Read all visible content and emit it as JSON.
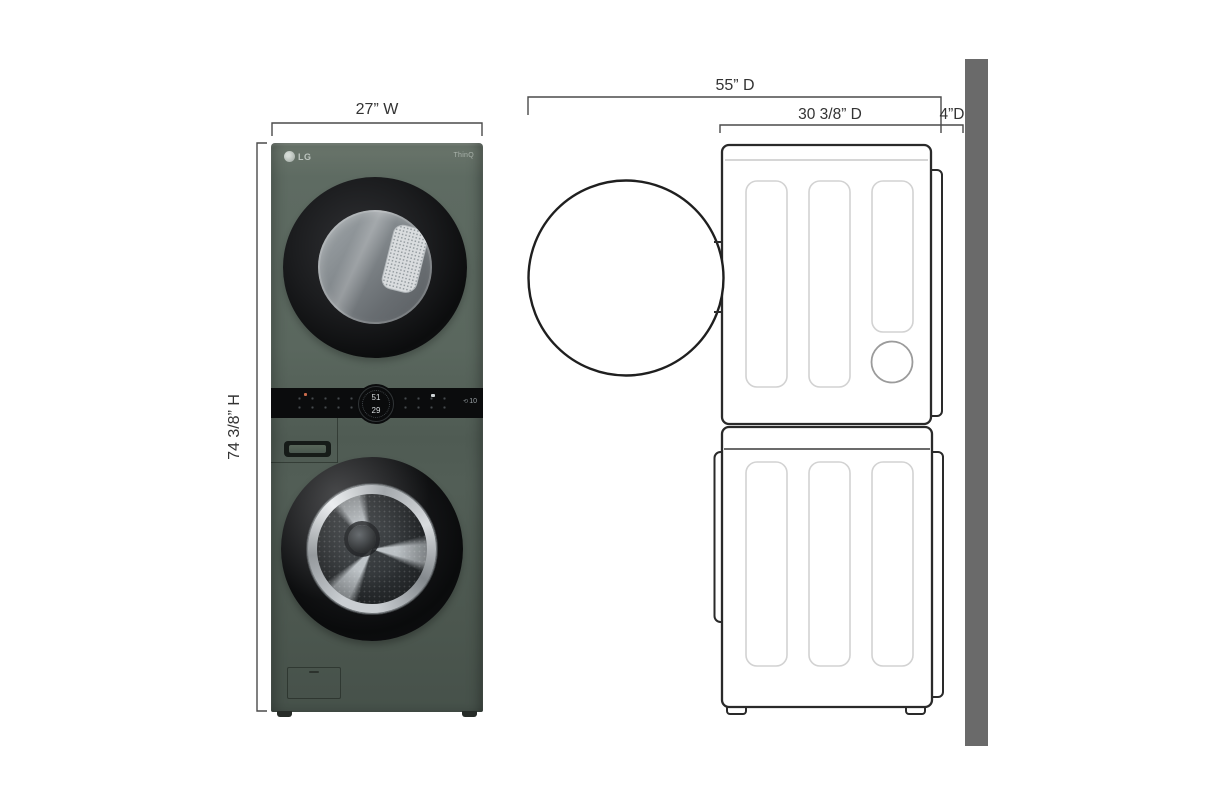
{
  "page": {
    "background": "#ffffff"
  },
  "dimensions": {
    "width_label": "27” W",
    "height_label": "74 3/8” H",
    "total_depth_label": "55” D",
    "unit_depth_label": "30 3/8” D",
    "wall_clearance_label": "4”D"
  },
  "front_view": {
    "brand_logo": "LG",
    "smart_badge": "ThinQ",
    "display_top_value": "51",
    "display_bottom_value": "29",
    "warranty_badge": "10",
    "body_color": "#57645b",
    "control_panel_color": "#0b0c0d"
  },
  "side_view": {
    "wall_color": "#6a6a6a",
    "outline_color": "#2a2a2a",
    "panel_line_color": "#d2d2d2"
  }
}
